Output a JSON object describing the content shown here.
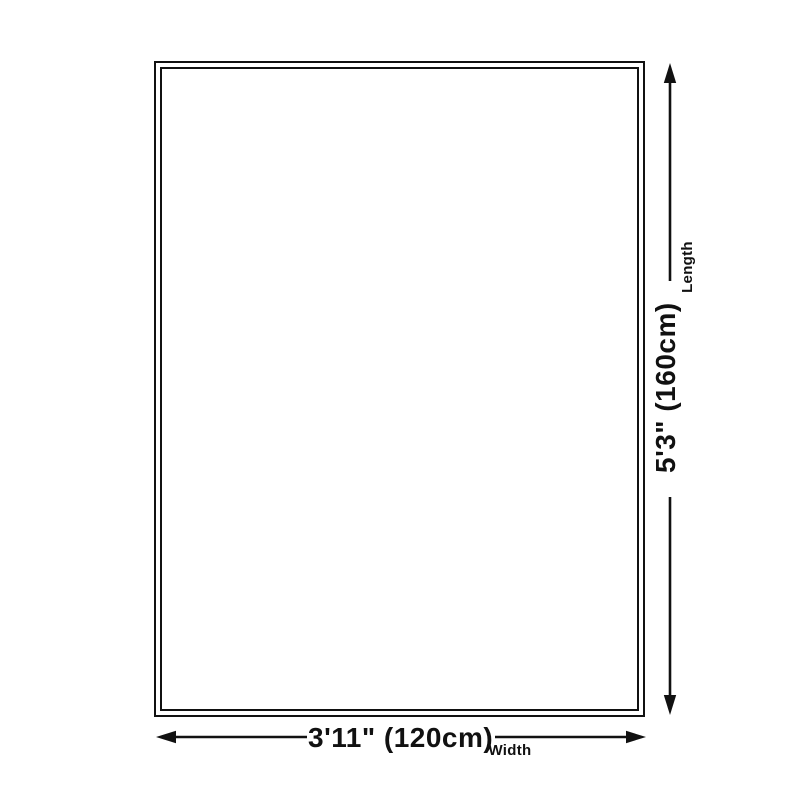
{
  "diagram": {
    "title": "rug-size-dimension-diagram",
    "background_color": "#ffffff",
    "line_color": "#111111",
    "rug": {
      "border_style": "double",
      "fill_color": "#ffffff"
    },
    "length_dimension": {
      "value": "5'3\" (160cm)",
      "label": "Length"
    },
    "width_dimension": {
      "value": "3'11\" (120cm)",
      "label": "Width"
    }
  }
}
